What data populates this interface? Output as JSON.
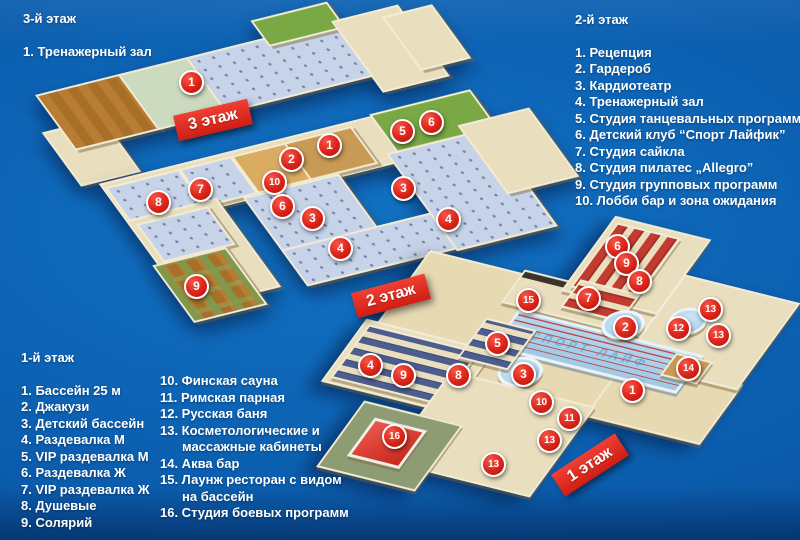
{
  "palette": {
    "bg1": "#1172c4",
    "bg2": "#0b5cad",
    "bg3": "#094c98",
    "wall": "#f3ecd4",
    "beige": "#e9dfbe",
    "sand": "#e7d9b2",
    "wood": "#b87c33",
    "gym": "#c7d3e8",
    "green": "#79a844",
    "palegreen": "#ccdabf",
    "pool": "#b5d7ee",
    "locker": "#4d5d8d",
    "sauna": "#c23b30",
    "marker_red": "#dc2318",
    "ribbon_red": "#e02a1e",
    "text": "#ffffff"
  },
  "legends": {
    "floor3": {
      "title": "3-й этаж",
      "items": [
        "1. Тренажерный зал"
      ]
    },
    "floor2": {
      "title": "2-й этаж",
      "items": [
        "1. Рецепция",
        "2. Гардероб",
        "3. Кардиотеатр",
        "4. Тренажерный зал",
        "5. Студия танцевальных программ",
        "6. Детский клуб  “Спорт Лайфик”",
        "7. Студия сайкла",
        "8. Студия пилатес „Allegro”",
        "9. Студия групповых программ",
        "10. Лобби бар и зона ожидания"
      ]
    },
    "floor1": {
      "title": "1-й этаж",
      "items": [
        "1. Бассейн 25 м",
        "2. Джакузи",
        "3. Детский бассейн",
        "4. Раздевалка М",
        "5. VIP раздевалка М",
        "6. Раздевалка Ж",
        "7. VIP раздевалка Ж",
        "8. Душевые",
        "9. Солярий"
      ]
    },
    "floor1b": {
      "items": [
        "10. Финская сауна",
        "11.  Римская парная",
        "12. Русская баня",
        "13. Косметологические и",
        "массажные кабинеты",
        "14. Аква бар",
        "15. Лаунж ресторан с видом",
        "на бассейн",
        "16. Студия боевых программ"
      ]
    }
  },
  "ribbons": {
    "floor3": "3 этаж",
    "floor2": "2 этаж",
    "floor1": "1 этаж"
  },
  "pool_watermark": "СПОРТ ЛАЙФ",
  "markers": [
    {
      "f": 3,
      "n": "1",
      "x": 190,
      "y": 81
    },
    {
      "f": 2,
      "n": "1",
      "x": 328,
      "y": 144
    },
    {
      "f": 2,
      "n": "2",
      "x": 290,
      "y": 158
    },
    {
      "f": 2,
      "n": "10",
      "x": 273,
      "y": 181
    },
    {
      "f": 2,
      "n": "7",
      "x": 199,
      "y": 188
    },
    {
      "f": 2,
      "n": "8",
      "x": 157,
      "y": 201
    },
    {
      "f": 2,
      "n": "6",
      "x": 281,
      "y": 205
    },
    {
      "f": 2,
      "n": "3",
      "x": 311,
      "y": 217
    },
    {
      "f": 2,
      "n": "3",
      "x": 402,
      "y": 187
    },
    {
      "f": 2,
      "n": "4",
      "x": 339,
      "y": 247
    },
    {
      "f": 2,
      "n": "4",
      "x": 447,
      "y": 218
    },
    {
      "f": 2,
      "n": "5",
      "x": 401,
      "y": 130
    },
    {
      "f": 2,
      "n": "6",
      "x": 430,
      "y": 121
    },
    {
      "f": 2,
      "n": "9",
      "x": 195,
      "y": 285
    },
    {
      "f": 1,
      "n": "15",
      "x": 527,
      "y": 299
    },
    {
      "f": 1,
      "n": "6",
      "x": 616,
      "y": 245
    },
    {
      "f": 1,
      "n": "9",
      "x": 625,
      "y": 262
    },
    {
      "f": 1,
      "n": "8",
      "x": 638,
      "y": 280
    },
    {
      "f": 1,
      "n": "7",
      "x": 587,
      "y": 297
    },
    {
      "f": 1,
      "n": "13",
      "x": 709,
      "y": 308
    },
    {
      "f": 1,
      "n": "2",
      "x": 624,
      "y": 326
    },
    {
      "f": 1,
      "n": "12",
      "x": 677,
      "y": 327
    },
    {
      "f": 1,
      "n": "13",
      "x": 717,
      "y": 334
    },
    {
      "f": 1,
      "n": "5",
      "x": 496,
      "y": 342
    },
    {
      "f": 1,
      "n": "4",
      "x": 369,
      "y": 364
    },
    {
      "f": 1,
      "n": "9",
      "x": 402,
      "y": 374
    },
    {
      "f": 1,
      "n": "8",
      "x": 457,
      "y": 374
    },
    {
      "f": 1,
      "n": "3",
      "x": 522,
      "y": 373
    },
    {
      "f": 1,
      "n": "14",
      "x": 687,
      "y": 367
    },
    {
      "f": 1,
      "n": "1",
      "x": 631,
      "y": 389
    },
    {
      "f": 1,
      "n": "10",
      "x": 540,
      "y": 401
    },
    {
      "f": 1,
      "n": "11",
      "x": 568,
      "y": 417
    },
    {
      "f": 1,
      "n": "16",
      "x": 393,
      "y": 435
    },
    {
      "f": 1,
      "n": "13",
      "x": 548,
      "y": 439
    },
    {
      "f": 1,
      "n": "13",
      "x": 492,
      "y": 463
    }
  ]
}
